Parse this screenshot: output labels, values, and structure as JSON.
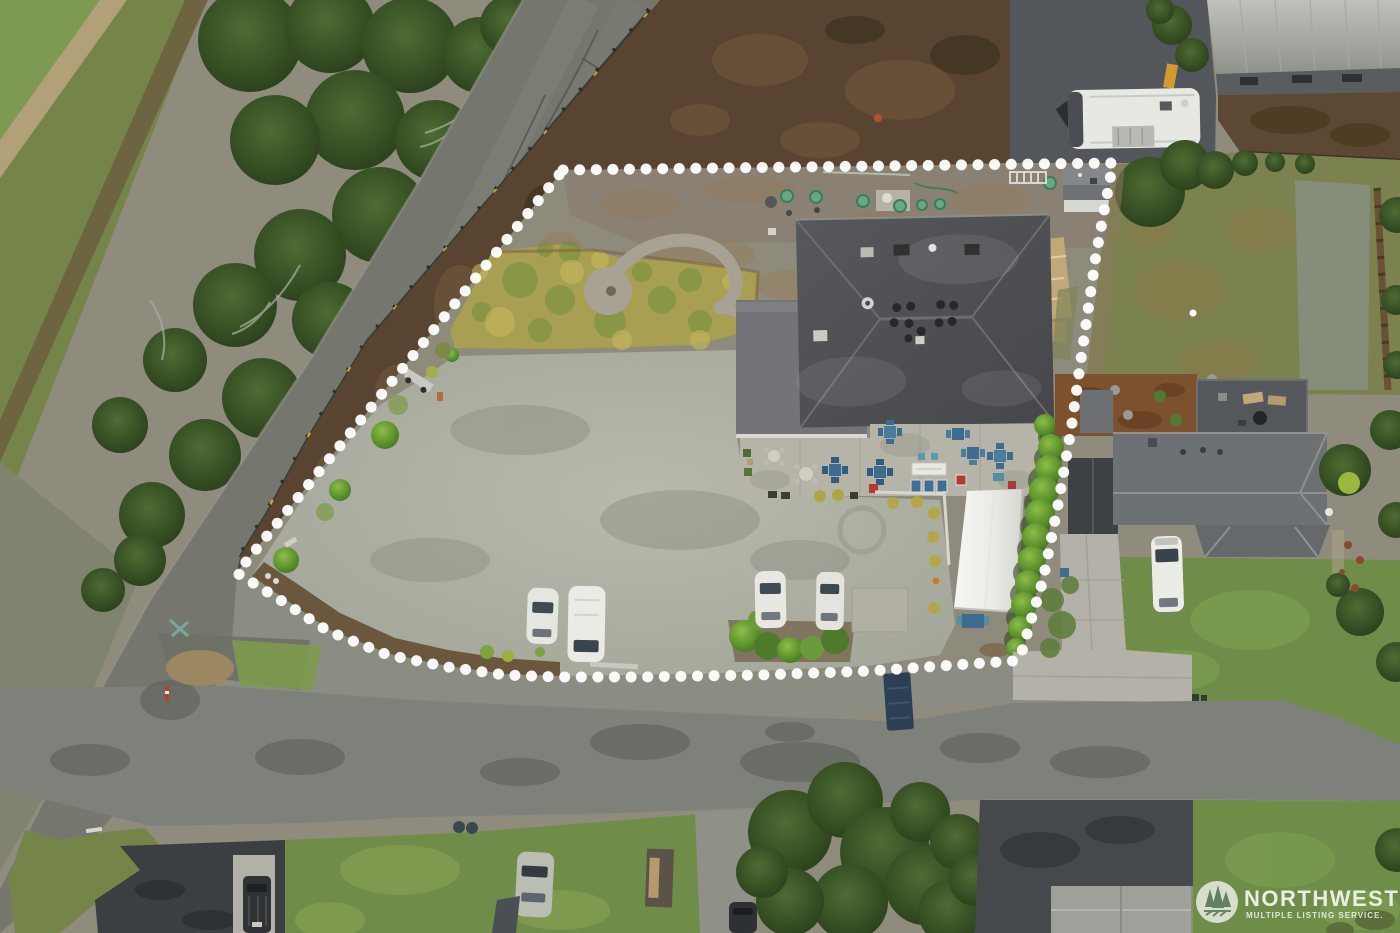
{
  "image": {
    "type": "aerial-drone-photograph",
    "subject": "commercial property lot outlined with dotted boundary",
    "width_px": 1400,
    "height_px": 933
  },
  "overlay": {
    "watermark": {
      "brand": "NORTHWEST",
      "subtitle": "MULTIPLE LISTING SERVICE.",
      "logo": "evergreen-trees-badge",
      "text_color": "#ffffff"
    },
    "boundary": {
      "style": "white-dotted-line",
      "color": "#ffffff",
      "shape": "irregular quadrilateral following road frontage"
    }
  },
  "scene": {
    "features": [
      "tree-lined highway running diagonally on left",
      "guardrail with yellow reflectors along highway",
      "gravel lot interior with light parking area",
      "spiral/wave shaped gravel garden path in lawn",
      "large dark hip-roof building with roof vents",
      "flat-roof annex on west side of building",
      "patio with blue and teal table sets, white buffet table, red chairs",
      "white event tent / canopy",
      "row of round trimmed hedge bushes along east boundary",
      "4 white cars parked in gravel lot",
      "storage shed at northeast corner",
      "white RV trailer parked at top right",
      "metal warehouse building top right corner",
      "neighboring house with gray roof, concrete driveway and white van",
      "backyard deck with loungers and grill",
      "bark mulch bed with planters",
      "cross street along bottom with driveways",
      "dark asphalt parking pad bottom left with dark SUV",
      "lawns with parked cars, tarp and shed at bottom",
      "blue dumpster near road",
      "bottom-center house roof and driveway"
    ],
    "colors": {
      "asphalt_road": "#75776f",
      "cross_road": "#7e807a",
      "gravel_light": "#a9ac9e",
      "gravel_dark": "#8a8174",
      "dirt_brown": "#584430",
      "building_roof": "#4e5053",
      "neighbor_roof": "#6e7173",
      "tree_green": "#2c401d",
      "hedge_green": "#5a9a2e",
      "lawn_green": "#6f8c49",
      "tent_white": "#f4f4f1",
      "mulch_red_brown": "#7d512e",
      "dumpster_blue": "#2b3f55"
    },
    "vehicle_counts": {
      "white_cars_in_lot": 4,
      "rv_trailers": 1,
      "vans": 1,
      "other_cars": 3
    }
  }
}
